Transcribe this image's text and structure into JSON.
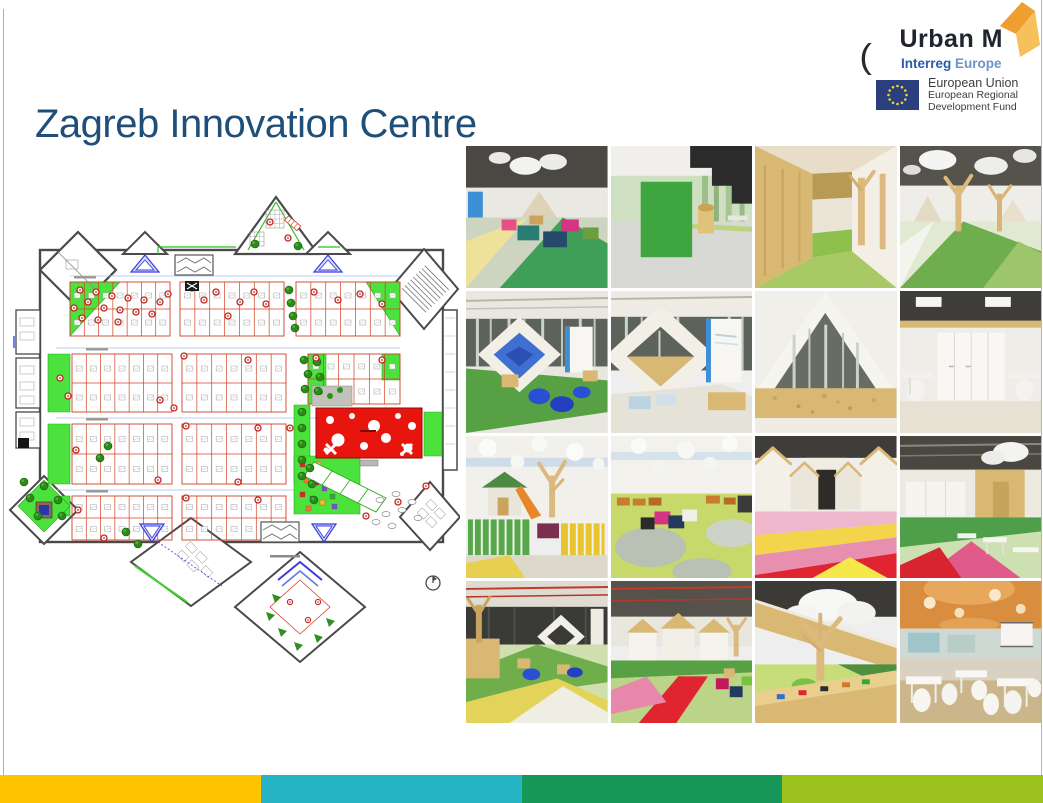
{
  "slide": {
    "title": "Zagreb Innovation Centre"
  },
  "header": {
    "urban_m": {
      "brand": "Urban M",
      "program_bold": "Interreg",
      "program_light": "Europe"
    },
    "partial_mark": "(",
    "eu_attribution": {
      "line1": "European Union",
      "line2": "European Regional",
      "line3": "Development Fund"
    }
  },
  "floor_plan": {
    "alt": "Ground floor plan of the Zagreb Innovation Centre with office clusters, green areas and play zones"
  },
  "photo_grid": {
    "photos": [
      {
        "alt": "Colourful cube seating under cloud lamps"
      },
      {
        "alt": "Green meeting cube beside black mezzanine stair"
      },
      {
        "alt": "OSB timber corridor with green floor"
      },
      {
        "alt": "Open plan area with wooden tree columns and cloud lamps"
      },
      {
        "alt": "Diamond portal with blue bean bags and birch wall"
      },
      {
        "alt": "Diamond portal and white info panel"
      },
      {
        "alt": "OSB reception desk under A-frame"
      },
      {
        "alt": "White team office with wardrobes"
      },
      {
        "alt": "Indoor playground with picket fences and slide"
      },
      {
        "alt": "Playroom with circular floor pattern and cube seats"
      },
      {
        "alt": "Gabled corridor with pink and yellow floor"
      },
      {
        "alt": "OSB meeting box with coloured floor"
      },
      {
        "alt": "Flexible work landscape with diamond portal"
      },
      {
        "alt": "White huts village with red floor path"
      },
      {
        "alt": "Wooden tree and cloud light detail"
      },
      {
        "alt": "Canteen with white tables and chairs"
      }
    ]
  },
  "footer": {
    "segment_colors": [
      "#FFC600",
      "#26B5C4",
      "#179758",
      "#9CC31D"
    ]
  }
}
